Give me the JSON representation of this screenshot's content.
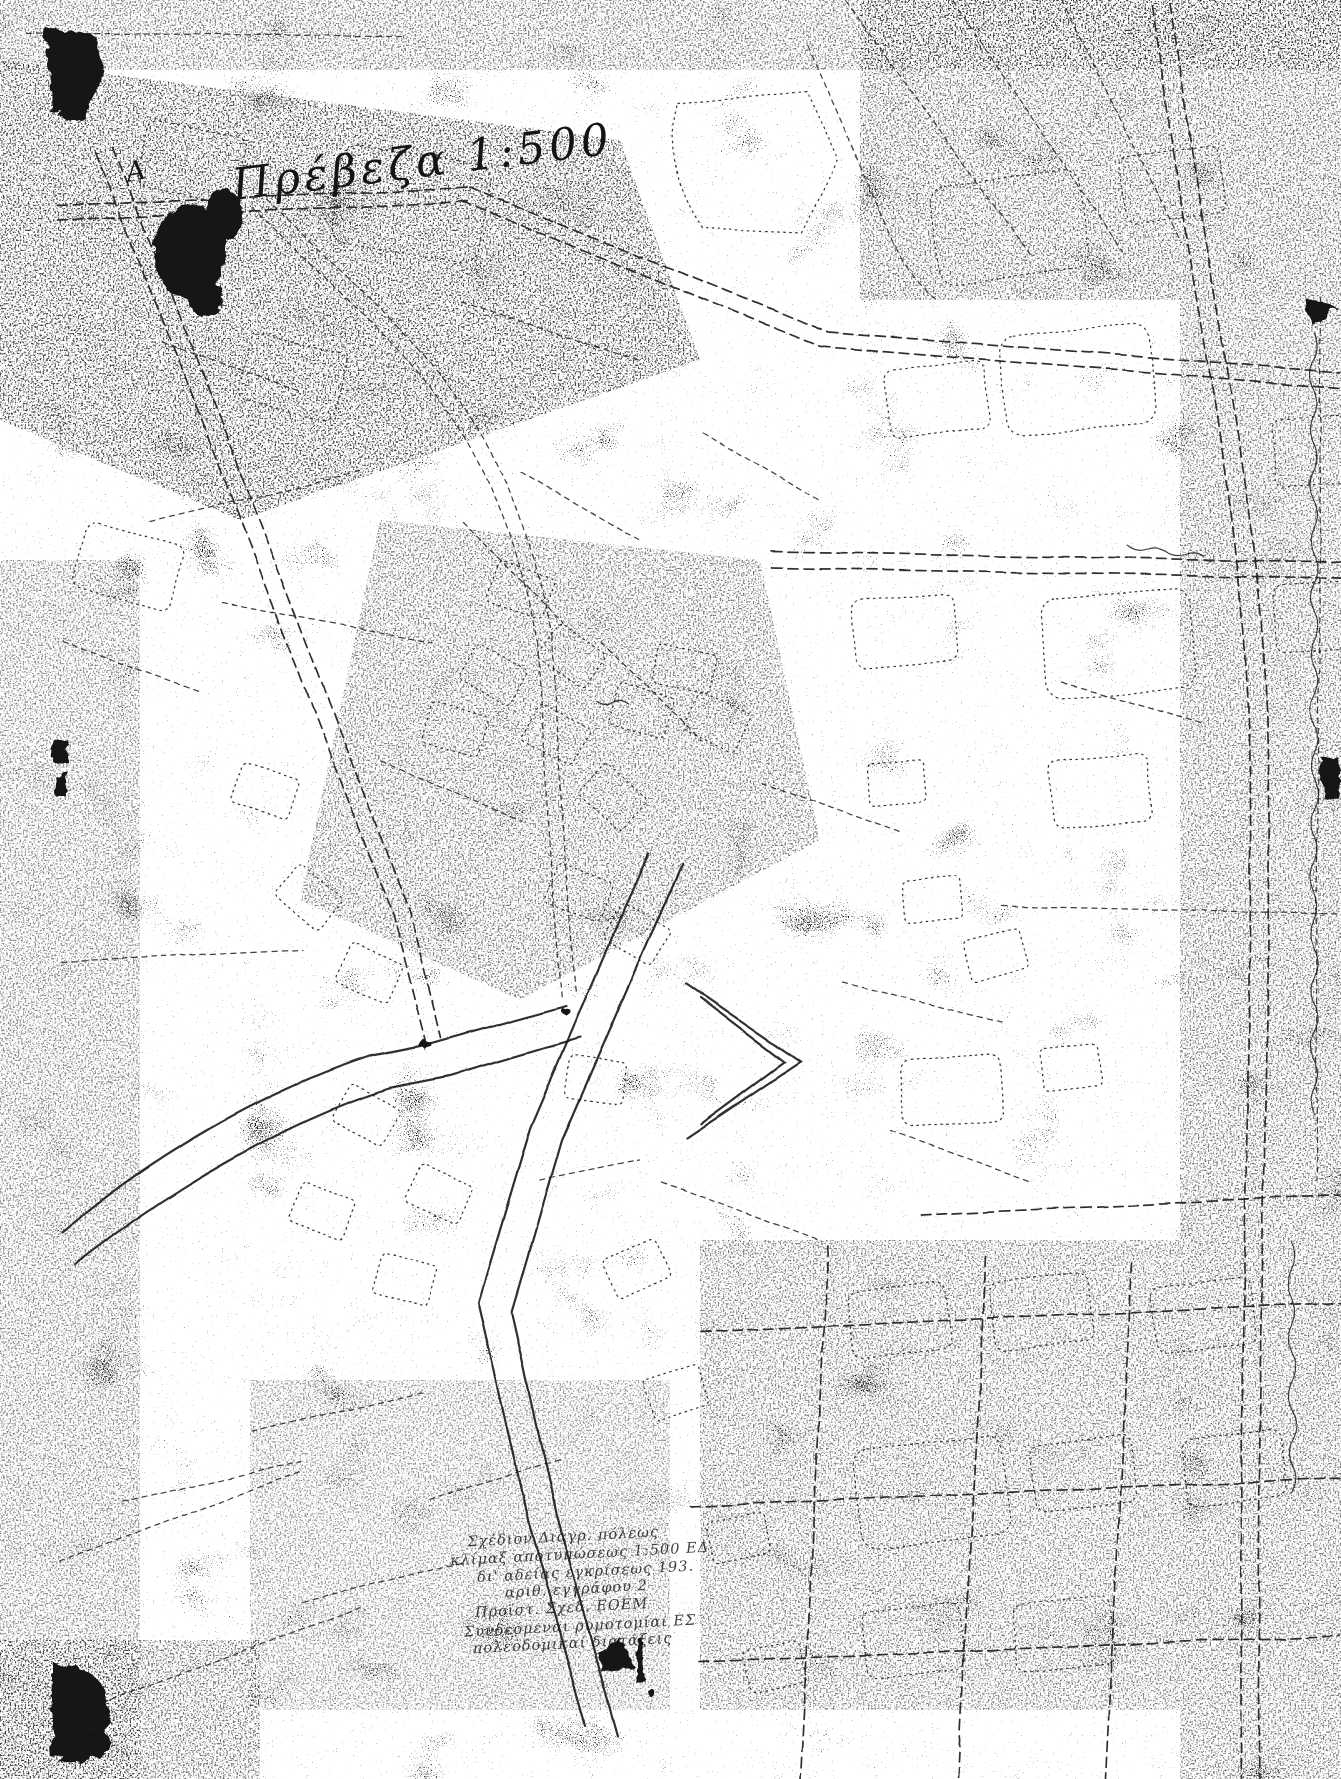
{
  "page": {
    "background_color": "#ffffff",
    "ink_color": "#141414"
  },
  "map": {
    "title": {
      "text": "Πρέβεζα 1:500"
    },
    "corner_marker": {
      "text": "A"
    },
    "annotation_block": {
      "lines": [
        "Σχέδιον Διαγρ. πόλεως",
        "κλίμαξ αποτυπώσεως 1:500 ΕΔ",
        "δι' αδείας εγκρίσεως 193.",
        "αριθ. εγγράφου 2",
        "Προϊστ. Σχεδ. ΕΟΕΜ",
        "Συνδεόμεναι ρυμοτομίαι ΕΣ",
        "πολεοδομικαί διατάξεις"
      ]
    }
  }
}
